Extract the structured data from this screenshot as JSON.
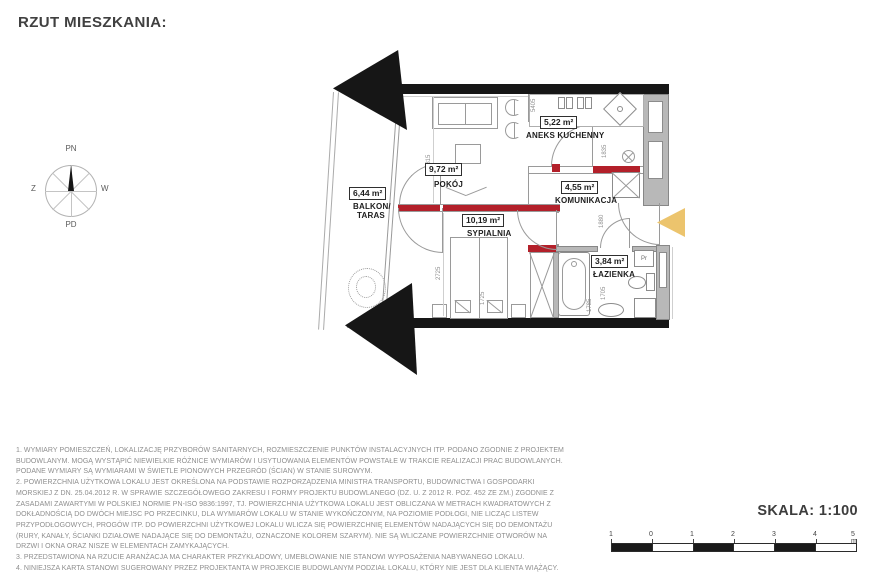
{
  "title": "RZUT MIESZKANIA:",
  "compass": {
    "north": "PN",
    "south": "PD",
    "west_label": "Z",
    "east_label": "W"
  },
  "plan": {
    "rooms": {
      "pokoj": {
        "area": "9,72 m²",
        "name": "POKÓJ"
      },
      "aneks": {
        "area": "5,22 m²",
        "name": "ANEKS KUCHENNY"
      },
      "komunikacja": {
        "area": "4,55 m²",
        "name": "KOMUNIKACJA"
      },
      "sypialnia": {
        "area": "10,19 m²",
        "name": "SYPIALNIA"
      },
      "lazienka": {
        "area": "3,84 m²",
        "name": "ŁAZIENKA"
      },
      "balkon": {
        "area": "6,44 m²",
        "name_line1": "BALKON/",
        "name_line2": "TARAS"
      }
    },
    "dims": {
      "pokoj_h": "2815",
      "sypialnia_h": "2725",
      "bed_w": "1725",
      "kitchen_w": "5405",
      "kitchen_h": "1835",
      "hall_h": "1880",
      "bath_h": "1705",
      "bath_w": "1785"
    },
    "washer": "Pr",
    "colors": {
      "wall": "#161616",
      "wall_gray": "#b8b8b8",
      "red_marker": "#b3202a",
      "entry_arrow": "#ecc46d"
    }
  },
  "notes": [
    "1. WYMIARY POMIESZCZEŃ, LOKALIZACJĘ PRZYBORÓW SANITARNYCH, ROZMIESZCZENIE PUNKTÓW INSTALACYJNYCH ITP. PODANO ZGODNIE Z PROJEKTEM BUDOWLANYM. MOGĄ WYSTĄPIĆ NIEWIELKIE RÓŻNICE WYMIARÓW I USYTUOWANIA ELEMENTÓW POWSTAŁE W TRAKCIE REALIZACJI PRAC BUDOWLANYCH. PODANE WYMIARY SĄ WYMIARAMI W ŚWIETLE PIONOWYCH PRZEGRÓD (ŚCIAN) W STANIE SUROWYM.",
    "2. POWIERZCHNIA UŻYTKOWA LOKALU JEST OKREŚLONA NA PODSTAWIE ROZPORZĄDZENIA MINISTRA TRANSPORTU, BUDOWNICTWA I GOSPODARKI MORSKIEJ Z DN. 25.04.2012 R. W SPRAWIE SZCZEGÓŁOWEGO ZAKRESU I FORMY PROJEKTU BUDOWLANEGO (DZ. U. Z 2012 R. POZ. 452 ZE ZM.) ZGODNIE Z ZASADAMI ZAWARTYMI W POLSKIEJ NORMIE PN-ISO 9836:1997, TJ. POWIERZCHNIA UŻYTKOWA LOKALU JEST OBLICZANA W METRACH KWADRATOWYCH Z DOKŁADNOŚCIĄ DO DWÓCH MIEJSC PO PRZECINKU, DLA WYMIARÓW LOKALU W STANIE WYKOŃCZONYM, NA POZIOMIE PODŁOGI, NIE LICZĄC LISTEW PRZYPODŁOGOWYCH, PROGÓW ITP. DO POWIERZCHNI UŻYTKOWEJ LOKALU WLICZA SIĘ POWIERZCHNIĘ ELEMENTÓW NADAJĄCYCH SIĘ DO DEMONTAŻU (RURY, KANAŁY, ŚCIANKI DZIAŁOWE NADAJĄCE SIĘ DO DEMONTAŻU, OZNACZONE KOLOREM SZARYM). NIE SĄ WLICZANE POWIERZCHNIE OTWORÓW NA DRZWI I OKNA ORAZ NISZE W ELEMENTACH ZAMYKAJĄCYCH.",
    "3. PRZEDSTAWIONA NA RZUCIE ARANŻACJA MA CHARAKTER PRZYKŁADOWY, UMEBLOWANIE NIE STANOWI WYPOSAŻENIA NABYWANEGO LOKALU.",
    "4. NINIEJSZA KARTA STANOWI SUGEROWANY PRZEZ PROJEKTANTA W PROJEKCIE BUDOWLANYM PODZIAŁ LOKALU, KTÓRY NIE JEST DLA KLIENTA WIĄŻĄCY."
  ],
  "scale": {
    "label": "SKALA: 1:100",
    "ticks": [
      "1",
      "0",
      "1",
      "2",
      "3",
      "4",
      "5 m"
    ]
  }
}
